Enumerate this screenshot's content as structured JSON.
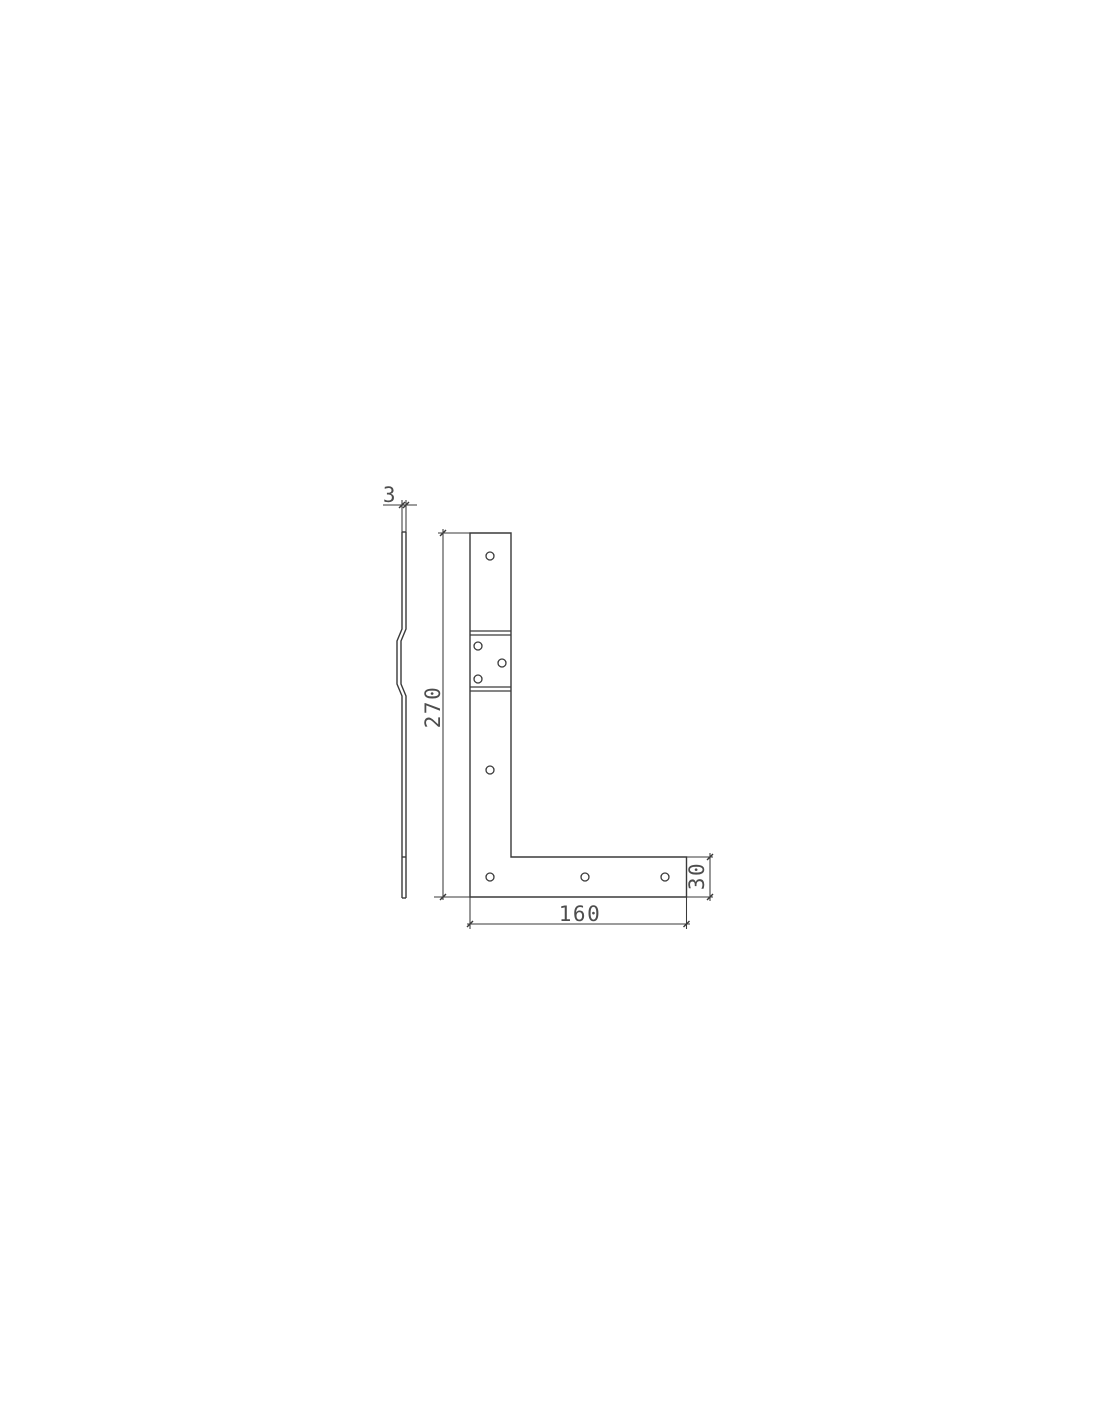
{
  "drawing": {
    "type": "technical-drawing-l-bracket",
    "background": "#ffffff",
    "line_color": "#3a3a3a",
    "text_color": "#4d4d4d",
    "dimensions": {
      "thickness": "3",
      "height": "270",
      "bottom_width": "160",
      "flange_height": "30"
    },
    "views": {
      "side": {
        "name": "side-profile",
        "holes": 0
      },
      "front": {
        "name": "front-view",
        "holes": 8
      }
    }
  }
}
